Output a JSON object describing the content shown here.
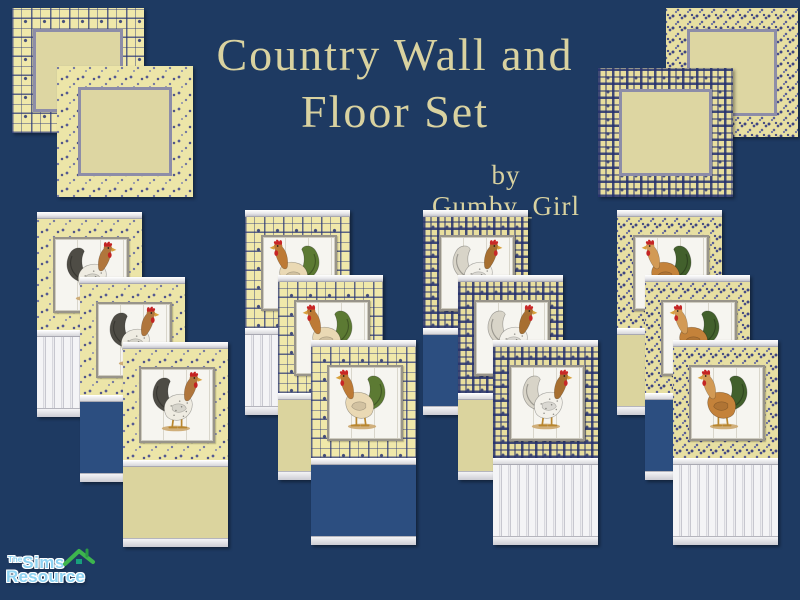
{
  "header": {
    "title_line1": "Country Wall and",
    "title_line2": "Floor Set",
    "byline": "by Gumby_Girl"
  },
  "floor_tiles": [
    {
      "name": "floor-tile-plaid-light",
      "pattern": "plaid-light",
      "position": "top-left-back"
    },
    {
      "name": "floor-tile-floral-sparse",
      "pattern": "floral-sparse",
      "position": "top-left-front"
    },
    {
      "name": "floor-tile-floral-dense",
      "pattern": "floral-dense",
      "position": "top-right-back"
    },
    {
      "name": "floor-tile-plaid-dense",
      "pattern": "plaid-dense",
      "position": "top-right-front"
    }
  ],
  "wall_groups": [
    {
      "wallpaper": "floral-sparse",
      "rooster": "gray_brown_right",
      "panels": [
        {
          "bottom": "stripes"
        },
        {
          "bottom": "blue"
        },
        {
          "bottom": "cream"
        }
      ]
    },
    {
      "wallpaper": "plaid-light",
      "rooster": "green_tail_left",
      "panels": [
        {
          "bottom": "stripes"
        },
        {
          "bottom": "cream"
        },
        {
          "bottom": "blue"
        }
      ]
    },
    {
      "wallpaper": "plaid-dense",
      "rooster": "white_speckled_right",
      "panels": [
        {
          "bottom": "blue"
        },
        {
          "bottom": "cream"
        },
        {
          "bottom": "stripes"
        }
      ]
    },
    {
      "wallpaper": "floral-dense",
      "rooster": "orange_green_left",
      "panels": [
        {
          "bottom": "cream"
        },
        {
          "bottom": "blue"
        },
        {
          "bottom": "stripes"
        }
      ]
    }
  ],
  "roosters": {
    "gray_brown_right": {
      "facing": "right",
      "body": "#efece2",
      "tail": "#4e4c45",
      "neck": "#b0763c",
      "comb": "#c32222",
      "speckled": true
    },
    "green_tail_left": {
      "facing": "left",
      "body": "#ead9b4",
      "tail": "#5c7a33",
      "neck": "#bd7a35",
      "comb": "#c82525",
      "speckled": false
    },
    "white_speckled_right": {
      "facing": "right",
      "body": "#f3f1ea",
      "tail": "#d8d4c8",
      "neck": "#a76f30",
      "comb": "#c82828",
      "speckled": true
    },
    "orange_green_left": {
      "facing": "left",
      "body": "#c4823a",
      "tail": "#42602c",
      "neck": "#d29a55",
      "comb": "#c42424",
      "speckled": false
    }
  },
  "logo": {
    "the": "The",
    "sims": "Sims",
    "resource": "Resource"
  },
  "colors": {
    "bg": "#1e3a62",
    "title_text": "#d9d2a0",
    "panel_blue": "#2c4e80",
    "cream": "#dbd49e",
    "wallpaper_yellow": "#ece5a8",
    "tile_center": "#ddd6a2",
    "tile_border": "#8d8da8",
    "logo_blue": "#8ed3f2",
    "roof_green": "#3db54e"
  }
}
